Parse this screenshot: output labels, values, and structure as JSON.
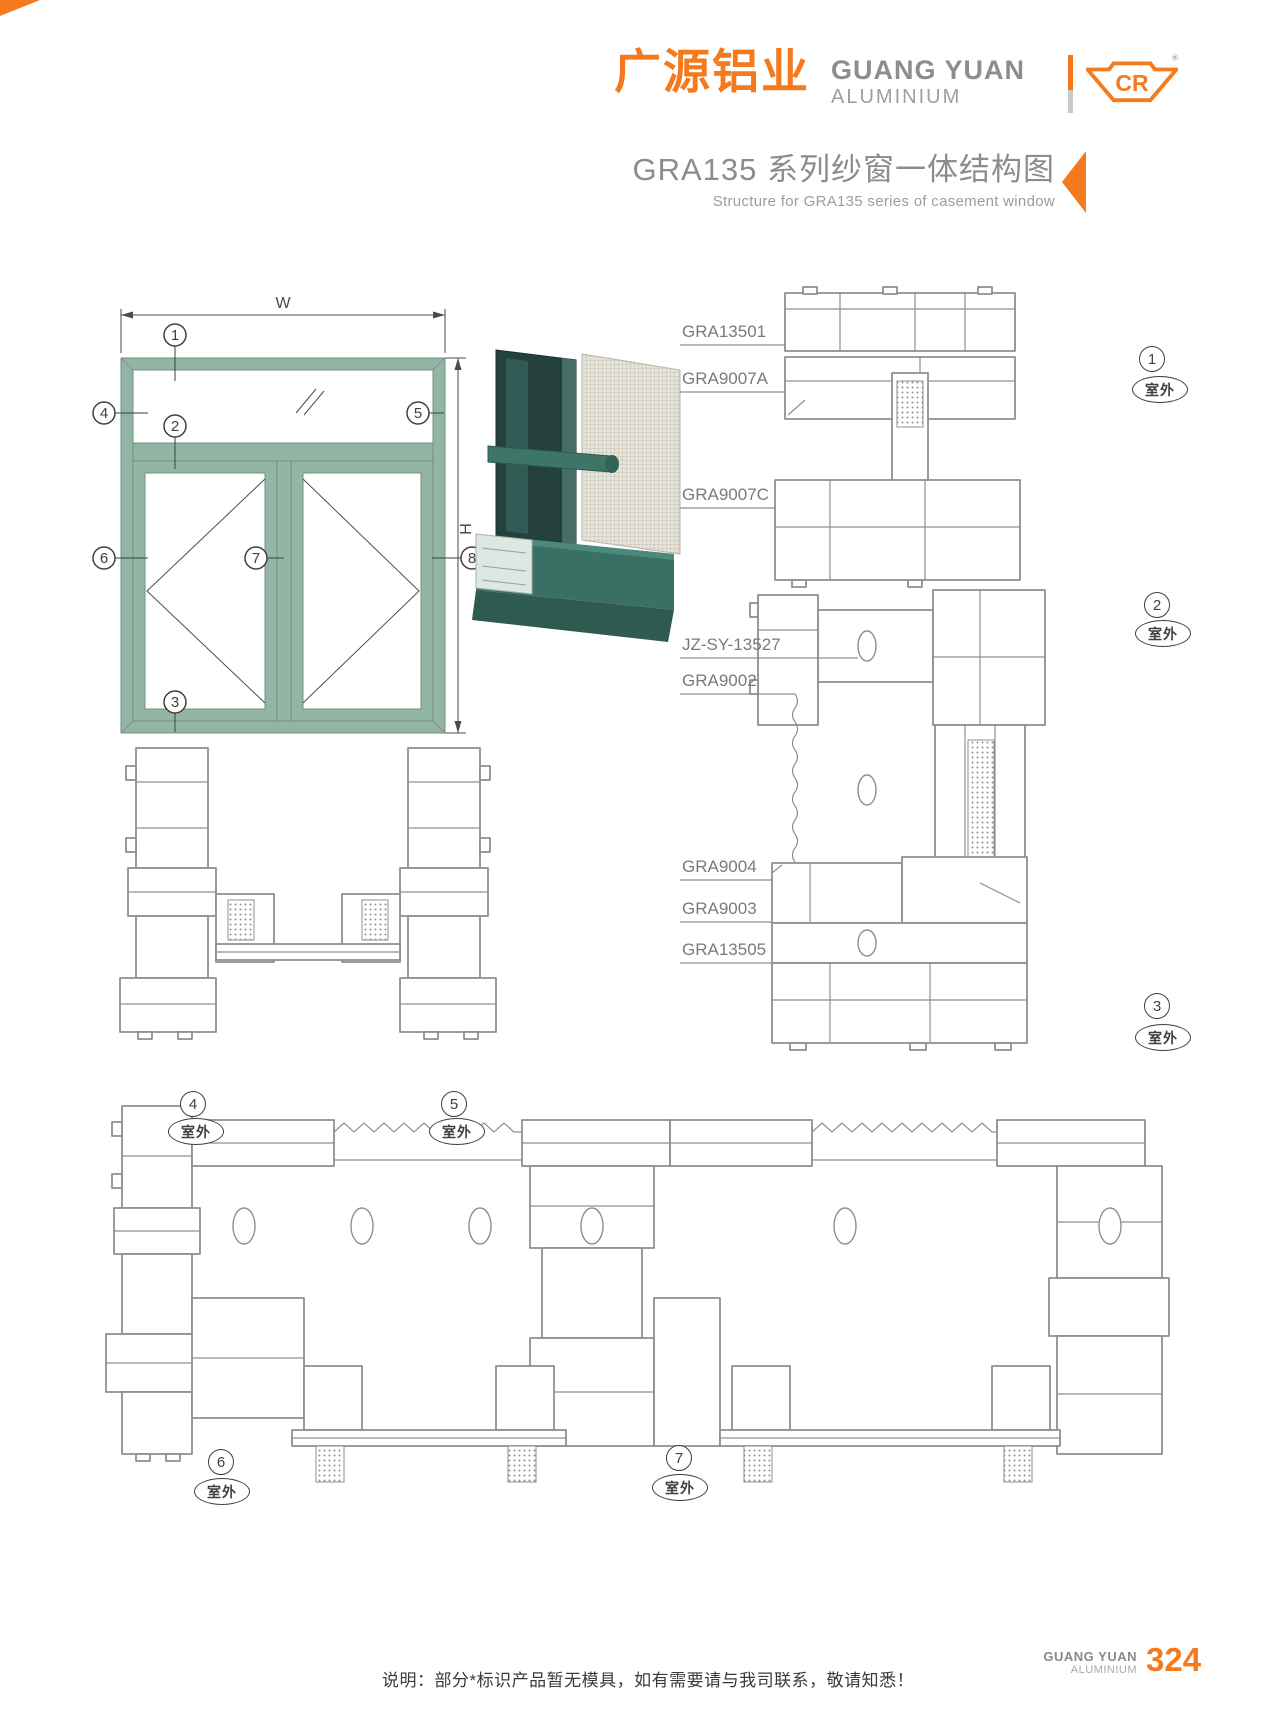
{
  "colors": {
    "accent_orange": "#f5791d",
    "title_gray": "#8c8c8c",
    "drawing_gray": "#8f8f8f",
    "frame_teal": "#93b6a4",
    "frame_teal_dark": "#6c9182"
  },
  "header": {
    "brand_cn": "广源铝业",
    "brand_en_line1": "GUANG YUAN",
    "brand_en_line2": "ALUMINIUM",
    "logo_mark": "CR",
    "registered_mark": "®"
  },
  "title": {
    "main": "GRA135 系列纱窗一体结构图",
    "sub": "Structure for GRA135 series of casement window"
  },
  "elevation": {
    "dim_width_label": "W",
    "dim_height_label": "H",
    "callouts": {
      "c1": "1",
      "c2": "2",
      "c3": "3",
      "c4": "4",
      "c5": "5",
      "c6": "6",
      "c7": "7",
      "c8": "8"
    }
  },
  "sections": {
    "labels": [
      "GRA13501",
      "GRA9007A",
      "GRA9007C",
      "JZ-SY-13527",
      "GRA9002",
      "GRA9004",
      "GRA9003",
      "GRA13505"
    ]
  },
  "markers": {
    "m1": {
      "num": "1",
      "label": "室外"
    },
    "m2": {
      "num": "2",
      "label": "室外"
    },
    "m3": {
      "num": "3",
      "label": "室外"
    },
    "m4": {
      "num": "4",
      "label": "室外"
    },
    "m5": {
      "num": "5",
      "label": "室外"
    },
    "m6": {
      "num": "6",
      "label": "室外"
    },
    "m7": {
      "num": "7",
      "label": "室外"
    }
  },
  "footer": {
    "note": "说明：部分*标识产品暂无模具，如有需要请与我司联系，敬请知悉！",
    "brand_line1": "GUANG YUAN",
    "brand_line2": "ALUMINIUM",
    "page_number": "324"
  }
}
